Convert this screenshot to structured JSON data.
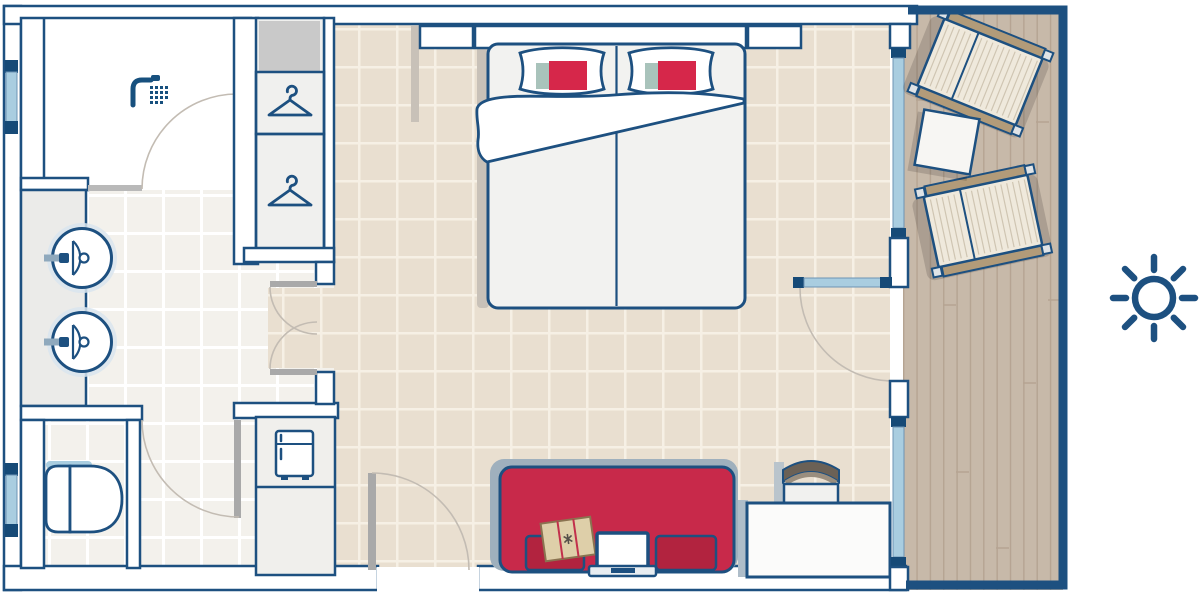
{
  "plan": {
    "kind": "hotel-room-floor-plan",
    "rooms": [
      "bathroom-with-shower",
      "vanity-corridor",
      "toilet-room",
      "bedroom-living-area",
      "balcony"
    ],
    "furniture": {
      "bathroom": [
        "shower",
        "sink",
        "sink",
        "toilet",
        "wardrobe-with-hangers"
      ],
      "bedroom": [
        "double-bed",
        "pillow",
        "pillow",
        "duvet",
        "minibar-fridge",
        "sofa",
        "book",
        "laptop",
        "desk",
        "desk-chair"
      ],
      "balcony": [
        "sun-lounger",
        "sun-lounger",
        "side-table"
      ],
      "outside": [
        "sun-symbol"
      ]
    },
    "doors": [
      "shower-door",
      "toilet-door",
      "double-swing-door",
      "entrance-door",
      "balcony-door"
    ],
    "windows": [
      "left-window-top",
      "left-window-bottom",
      "balcony-window-upper",
      "balcony-window-lower"
    ]
  },
  "colors": {
    "outline_blue": "#1d5080",
    "cap_blue": "#164a77",
    "glass": "#a9cde0",
    "room_floor": "#e9dfd0",
    "room_grout": "#f6f0e5",
    "bath_floor": "#f3f1ec",
    "bath_grout": "#ffffff",
    "balcony_floor": "#c7b9a9",
    "plank_line": "#b5a492",
    "sofa_red": "#c8294a",
    "cushion_red": "#b2233f",
    "pillow_red": "#d6274a",
    "pillow_teal": "#a9c3bb",
    "rail_tan": "#b29b79",
    "lounger_mat": "#efe9dc",
    "book_tan": "#decfa9",
    "door_gray": "#a9a9a9",
    "shelf_gray": "#c9c9c9",
    "shadow_warm": "#c8c1b8",
    "sofa_shadow": "#9fb0bd"
  }
}
